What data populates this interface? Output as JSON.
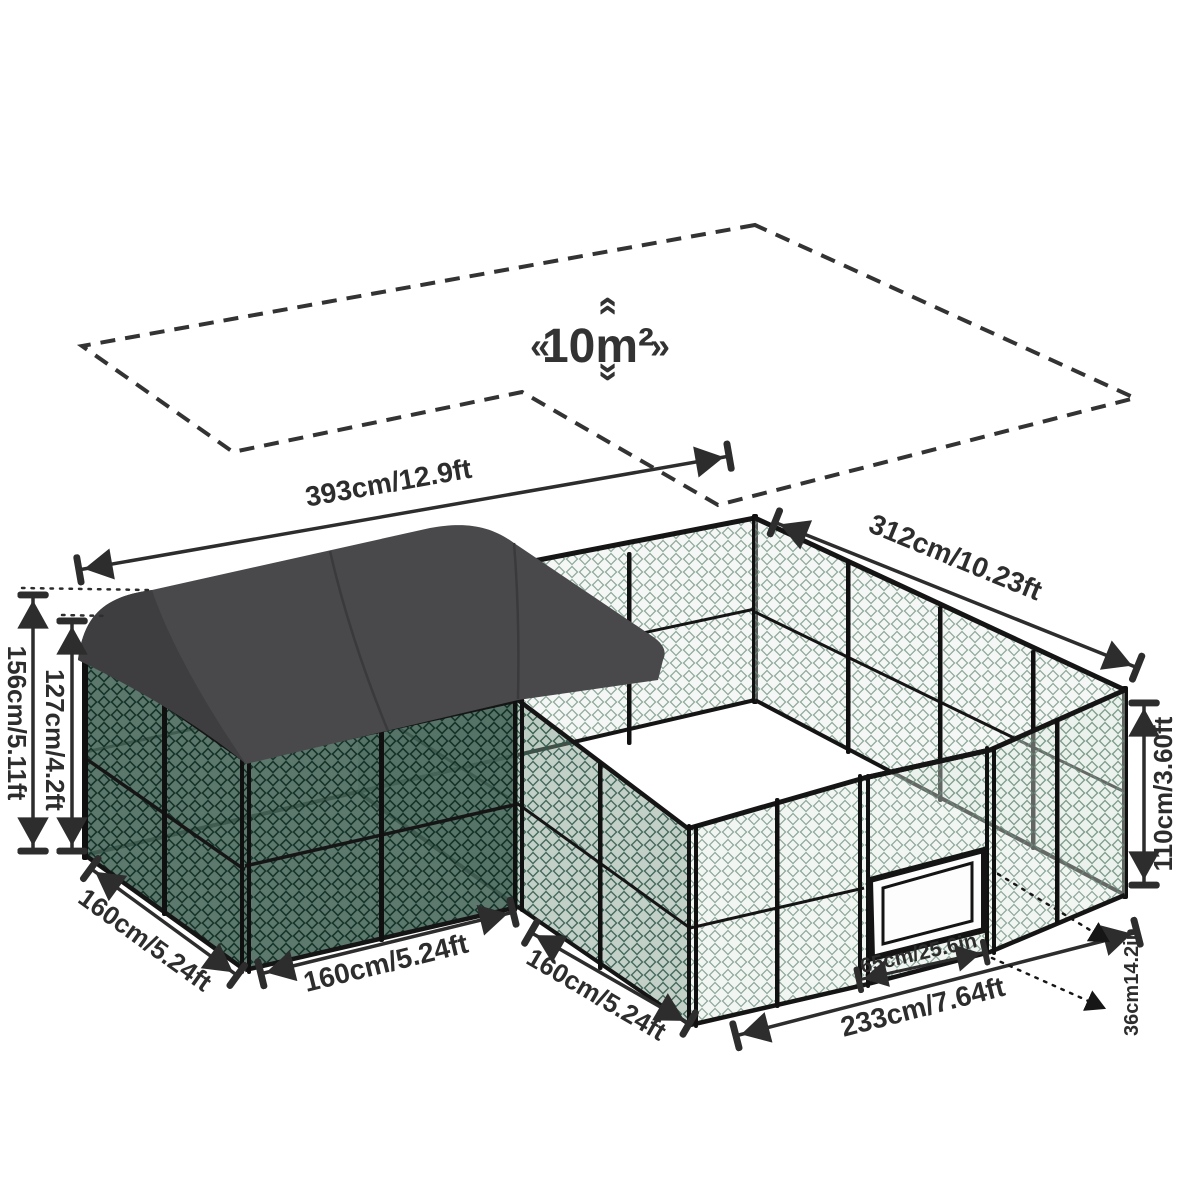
{
  "product_diagram": {
    "area_label": "10m²",
    "chevron_left": "«",
    "chevron_right": "»",
    "chevron_up": "«",
    "chevron_down": "»"
  },
  "dimensions": {
    "back_left_width": "393cm/12.9ft",
    "back_right_depth": "312cm/10.23ft",
    "peak_height": "156cm/5.11ft",
    "eave_height": "127cm/4.2ft",
    "wall_height": "110cm/3.60ft",
    "left_side_depth": "160cm/5.24ft",
    "left_front_width": "160cm/5.24ft",
    "inner_side_depth": "160cm/5.24ft",
    "front_width": "233cm/7.64ft",
    "door_width": "65cm/25.6in",
    "door_offset": "36cm14.2in"
  },
  "colors": {
    "roof": "#49494c",
    "roof_shade": "#3e3e41",
    "frame": "#141414",
    "dimension_ink": "#2d2d2d",
    "background": "#ffffff"
  }
}
